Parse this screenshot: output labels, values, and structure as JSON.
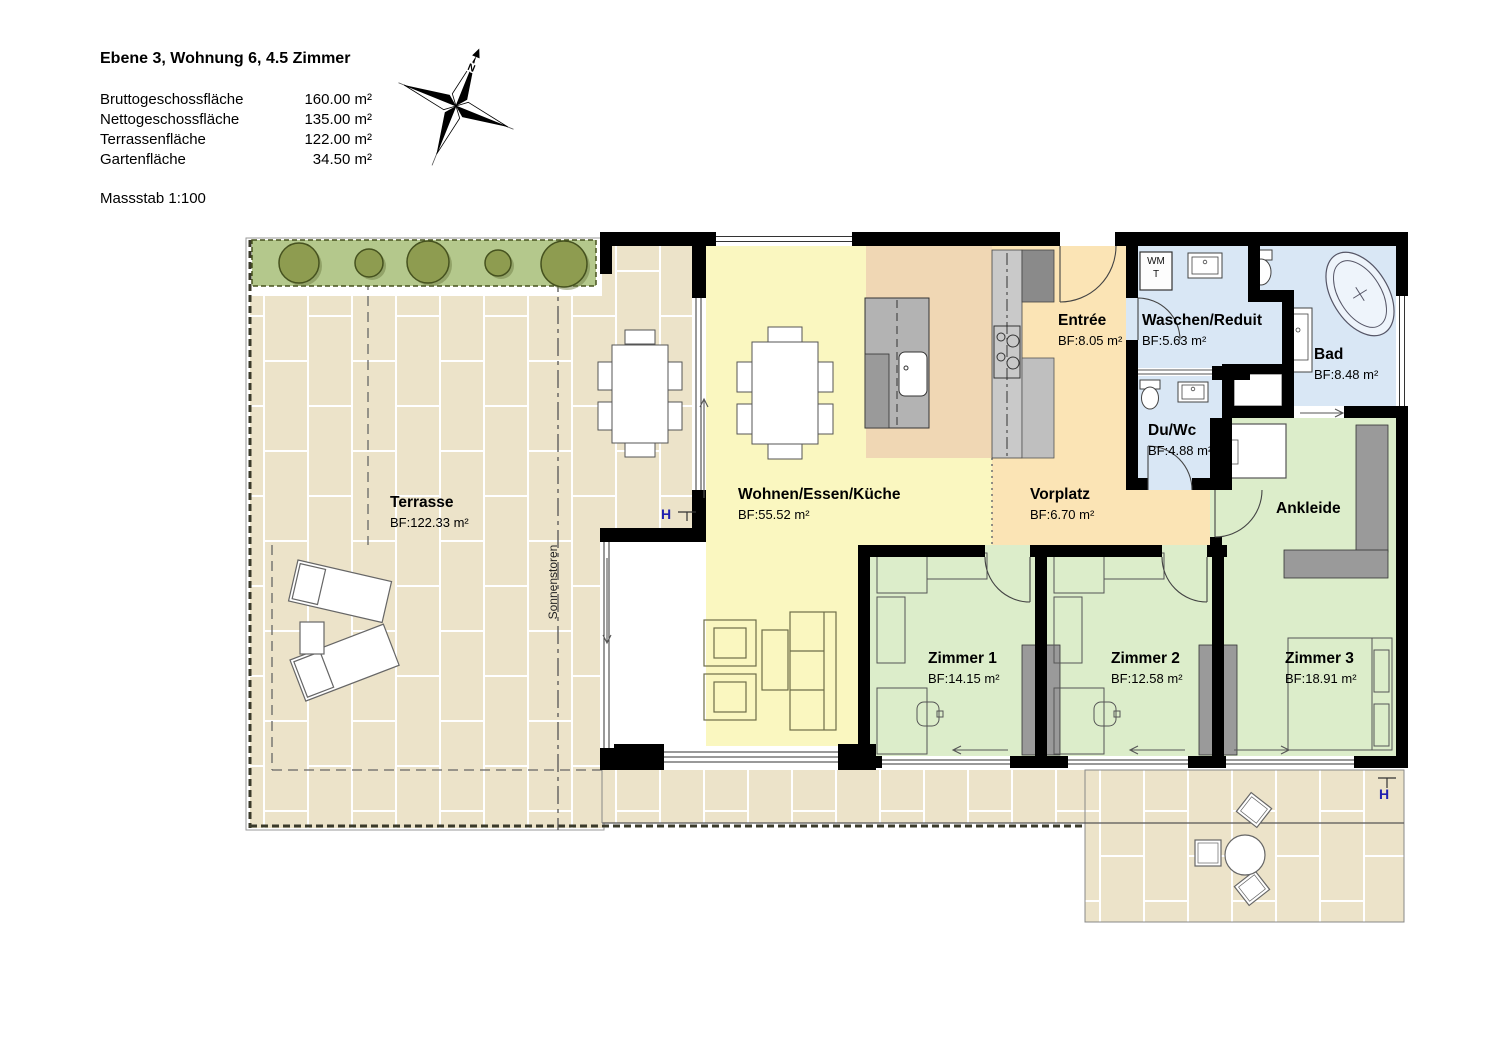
{
  "page": {
    "width": 1500,
    "height": 1060,
    "background": "#ffffff"
  },
  "header": {
    "title": "Ebene 3, Wohnung 6, 4.5 Zimmer",
    "area_table": [
      {
        "label": "Bruttogeschossfläche",
        "value": "160.00 m²"
      },
      {
        "label": "Nettogeschossfläche",
        "value": "135.00 m²"
      },
      {
        "label": "Terrassenfläche",
        "value": "122.00 m²"
      },
      {
        "label": "Gartenfläche",
        "value": "34.50 m²"
      }
    ],
    "scale_label": "Massstab 1:100"
  },
  "compass": {
    "north_label": "N"
  },
  "rooms": {
    "terrasse": {
      "name": "Terrasse",
      "area": "BF:122.33 m²"
    },
    "wohnen": {
      "name": "Wohnen/Essen/Küche",
      "area": "BF:55.52 m²"
    },
    "entree": {
      "name": "Entrée",
      "area": "BF:8.05 m²"
    },
    "waschen": {
      "name": "Waschen/Reduit",
      "area": "BF:5.63 m²"
    },
    "bad": {
      "name": "Bad",
      "area": "BF:8.48 m²"
    },
    "duwc": {
      "name": "Du/Wc",
      "area": "BF:4.88 m²"
    },
    "vorplatz": {
      "name": "Vorplatz",
      "area": "BF:6.70 m²"
    },
    "ankleide": {
      "name": "Ankleide"
    },
    "zimmer1": {
      "name": "Zimmer 1",
      "area": "BF:14.15 m²"
    },
    "zimmer2": {
      "name": "Zimmer 2",
      "area": "BF:12.58 m²"
    },
    "zimmer3": {
      "name": "Zimmer 3",
      "area": "BF:18.91 m²"
    }
  },
  "annotations": {
    "sonnenstoren_label": "Sonnenstoren",
    "washer_label": "WM",
    "tumbler_label": "T",
    "hydrant_label": "H"
  },
  "colors": {
    "wall": "#000000",
    "living": "#faf7c0",
    "kitchen": "#f0d7b4",
    "hallway": "#fbe4b5",
    "bathroom": "#d9e7f5",
    "bedroom": "#dcedca",
    "terrace_tile": "#ece3c9",
    "planter": "#b4c88c",
    "bush": "#8e9c50",
    "cabinet_gray": "#9a9a9a",
    "counter_gray": "#c9c9c9",
    "marker_blue": "#2020b0"
  }
}
